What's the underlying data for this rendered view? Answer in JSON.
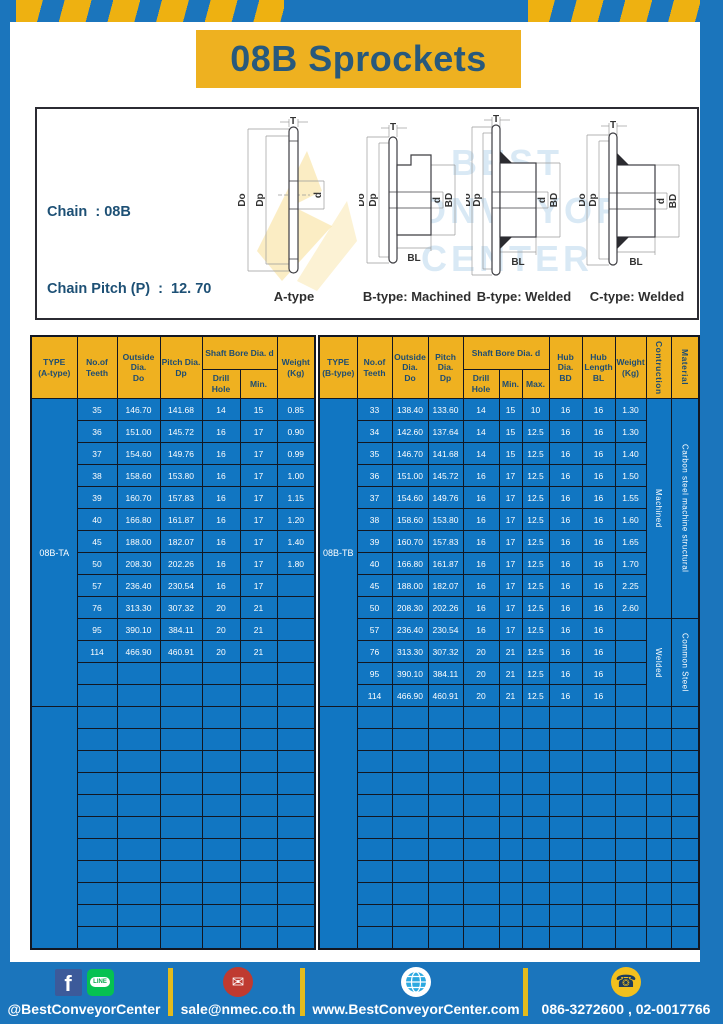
{
  "title": "08B Sprockets",
  "specs": {
    "lines": [
      "Chain  : 08B",
      "Chain Pitch (P)  :  12. 70",
      "Roller Link Inside Width (W)  :  7.75",
      "Roller Diameter (Dr)  : 8.51",
      "Teeth Width (T)  :  7.2"
    ]
  },
  "watermark": {
    "lines": [
      "BEST",
      "CONVEYOR",
      "CENTER"
    ]
  },
  "diagrams": {
    "dims": {
      "t": "T",
      "outside": "Do",
      "pitch": "Dp",
      "bore": "d",
      "hub_dia": "BD",
      "hub_len": "BL"
    },
    "captions": [
      "A-type",
      "B-type: Machined",
      "B-type: Welded",
      "C-type: Welded"
    ]
  },
  "table_a": {
    "headers": {
      "type": "TYPE\n(A-type)",
      "teeth": "No.of\nTeeth",
      "outside": "Outside\nDia.\nDo",
      "pitch": "Pitch Dia.\nDp",
      "shaft_bore": "Shaft Bore Dia. d",
      "drill": "Drill Hole",
      "min": "Min.",
      "weight": "Weight\n(Kg)"
    },
    "type_label": "08B-TA",
    "rows": [
      [
        "35",
        "146.70",
        "141.68",
        "14",
        "15",
        "0.85"
      ],
      [
        "36",
        "151.00",
        "145.72",
        "16",
        "17",
        "0.90"
      ],
      [
        "37",
        "154.60",
        "149.76",
        "16",
        "17",
        "0.99"
      ],
      [
        "38",
        "158.60",
        "153.80",
        "16",
        "17",
        "1.00"
      ],
      [
        "39",
        "160.70",
        "157.83",
        "16",
        "17",
        "1.15"
      ],
      [
        "40",
        "166.80",
        "161.87",
        "16",
        "17",
        "1.20"
      ],
      [
        "45",
        "188.00",
        "182.07",
        "16",
        "17",
        "1.40"
      ],
      [
        "50",
        "208.30",
        "202.26",
        "16",
        "17",
        "1.80"
      ],
      [
        "57",
        "236.40",
        "230.54",
        "16",
        "17",
        ""
      ],
      [
        "76",
        "313.30",
        "307.32",
        "20",
        "21",
        ""
      ],
      [
        "95",
        "390.10",
        "384.11",
        "20",
        "21",
        ""
      ],
      [
        "114",
        "466.90",
        "460.91",
        "20",
        "21",
        ""
      ]
    ],
    "empty_rows_in_group": 2,
    "empty_group_rows": 11
  },
  "table_b": {
    "headers": {
      "type": "TYPE\n(B-type)",
      "teeth": "No.of\nTeeth",
      "outside": "Outside\nDia.\nDo",
      "pitch": "Pitch Dia.\nDp",
      "shaft_bore": "Shaft Bore Dia. d",
      "drill": "Drill Hole",
      "min": "Min.",
      "max": "Max.",
      "hub_dia": "Hub Dia.\nBD",
      "hub_len": "Hub\nLength\nBL",
      "weight": "Weight\n(Kg)",
      "construction": "Contruction",
      "material": "Material"
    },
    "type_label": "08B-TB",
    "rows": [
      [
        "33",
        "138.40",
        "133.60",
        "14",
        "15",
        "10",
        "16",
        "16",
        "1.30"
      ],
      [
        "34",
        "142.60",
        "137.64",
        "14",
        "15",
        "12.5",
        "16",
        "16",
        "1.30"
      ],
      [
        "35",
        "146.70",
        "141.68",
        "14",
        "15",
        "12.5",
        "16",
        "16",
        "1.40"
      ],
      [
        "36",
        "151.00",
        "145.72",
        "16",
        "17",
        "12.5",
        "16",
        "16",
        "1.50"
      ],
      [
        "37",
        "154.60",
        "149.76",
        "16",
        "17",
        "12.5",
        "16",
        "16",
        "1.55"
      ],
      [
        "38",
        "158.60",
        "153.80",
        "16",
        "17",
        "12.5",
        "16",
        "16",
        "1.60"
      ],
      [
        "39",
        "160.70",
        "157.83",
        "16",
        "17",
        "12.5",
        "16",
        "16",
        "1.65"
      ],
      [
        "40",
        "166.80",
        "161.87",
        "16",
        "17",
        "12.5",
        "16",
        "16",
        "1.70"
      ],
      [
        "45",
        "188.00",
        "182.07",
        "16",
        "17",
        "12.5",
        "16",
        "16",
        "2.25"
      ],
      [
        "50",
        "208.30",
        "202.26",
        "16",
        "17",
        "12.5",
        "16",
        "16",
        "2.60"
      ],
      [
        "57",
        "236.40",
        "230.54",
        "16",
        "17",
        "12.5",
        "16",
        "16",
        ""
      ],
      [
        "76",
        "313.30",
        "307.32",
        "20",
        "21",
        "12.5",
        "16",
        "16",
        ""
      ],
      [
        "95",
        "390.10",
        "384.11",
        "20",
        "21",
        "12.5",
        "16",
        "16",
        ""
      ],
      [
        "114",
        "466.90",
        "460.91",
        "20",
        "21",
        "12.5",
        "16",
        "16",
        ""
      ]
    ],
    "construction_groups": [
      {
        "label": "Machined",
        "rows": 10
      },
      {
        "label": "Welded",
        "rows": 4
      }
    ],
    "material_groups": [
      {
        "label": "Carbon steel  machine structural",
        "rows": 10
      },
      {
        "label": "Common Steel",
        "rows": 4
      }
    ],
    "empty_group_rows": 11
  },
  "footer": {
    "social_text": "@BestConveyorCenter",
    "facebook_glyph": "f",
    "line_label": "LINE",
    "email": "sale@nmec.co.th",
    "mail_glyph": "✉",
    "website": "www.BestConveyorCenter.com",
    "phones": "086-3272600 , 02-0017766",
    "phone_glyph": "☎"
  },
  "colors": {
    "brand_blue": "#1b75bc",
    "brand_yellow": "#eeb120",
    "cell_blue": "#1176c2",
    "header_text": "#1d4c72",
    "border_dark": "#121722"
  }
}
